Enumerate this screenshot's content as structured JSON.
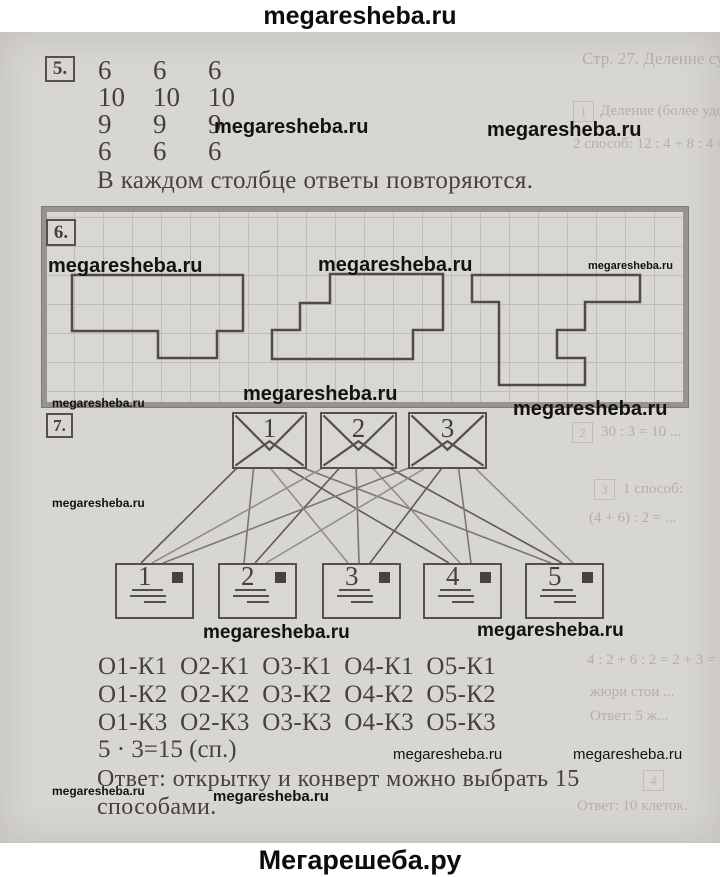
{
  "watermark_text": "megaresheba.ru",
  "header": {
    "site": "megaresheba.ru"
  },
  "footer": {
    "brand": "Мегарешеба.ру"
  },
  "problem5": {
    "label": "5.",
    "rows": [
      [
        "6",
        "6",
        "6"
      ],
      [
        "10",
        "10",
        "10"
      ],
      [
        "9",
        "9",
        "9"
      ],
      [
        "6",
        "6",
        "6"
      ]
    ],
    "note": "В каждом столбце ответы повторяются."
  },
  "problem6": {
    "label": "6.",
    "shapes": [
      {
        "name": "figure-left",
        "points": "72,275 243,275 243,331 217,331 217,358 158,358 158,331 72,331"
      },
      {
        "name": "figure-middle",
        "points": "330,274 443,274 443,330 413,330 413,359 272,359 272,330 300,330 300,303 330,303"
      },
      {
        "name": "figure-right",
        "points": "472,275 640,275 640,302 585,302 585,330 557,330 557,358 585,358 585,385 499,385 499,302 472,302"
      }
    ]
  },
  "problem7": {
    "label": "7.",
    "envelopes": [
      {
        "label": "1"
      },
      {
        "label": "2"
      },
      {
        "label": "3"
      }
    ],
    "postcards": [
      {
        "label": "1"
      },
      {
        "label": "2"
      },
      {
        "label": "3"
      },
      {
        "label": "4"
      },
      {
        "label": "5"
      }
    ],
    "envelope_anchors": [
      {
        "x": 267,
        "y": 464
      },
      {
        "x": 356,
        "y": 464
      },
      {
        "x": 445,
        "y": 464
      }
    ],
    "postcard_anchors": [
      {
        "x": 152,
        "y": 563
      },
      {
        "x": 255,
        "y": 563
      },
      {
        "x": 359,
        "y": 563
      },
      {
        "x": 460,
        "y": 563
      },
      {
        "x": 562,
        "y": 563
      }
    ],
    "line_colors": [
      "#5f5a55",
      "#7b7671",
      "#938e89"
    ],
    "combinations": [
      "О1-К1 О2-К1 О3-К1 О4-К1 О5-К1",
      "О1-К2 О2-К2 О3-К2 О4-К2 О5-К2",
      "О1-К3 О2-К3 О3-К3 О4-К3 О5-К3"
    ],
    "equation": "5 · 3=15 (сп.)",
    "answer_line1": "Ответ: открытку и конверт можно выбрать 15",
    "answer_line2": "способами."
  },
  "watermarks": [
    {
      "x": 214,
      "y": 117,
      "size": 20,
      "weight": 700
    },
    {
      "x": 487,
      "y": 120,
      "size": 20,
      "weight": 700
    },
    {
      "x": 48,
      "y": 256,
      "size": 20,
      "weight": 700
    },
    {
      "x": 318,
      "y": 255,
      "size": 20,
      "weight": 700
    },
    {
      "x": 588,
      "y": 261,
      "size": 11,
      "weight": 700
    },
    {
      "x": 243,
      "y": 384,
      "size": 20,
      "weight": 700
    },
    {
      "x": 52,
      "y": 397,
      "size": 12,
      "weight": 700
    },
    {
      "x": 513,
      "y": 399,
      "size": 20,
      "weight": 700
    },
    {
      "x": 52,
      "y": 497,
      "size": 12,
      "weight": 700
    },
    {
      "x": 203,
      "y": 623,
      "size": 19,
      "weight": 700
    },
    {
      "x": 477,
      "y": 621,
      "size": 19,
      "weight": 700
    },
    {
      "x": 393,
      "y": 747,
      "size": 15,
      "weight": 400
    },
    {
      "x": 573,
      "y": 747,
      "size": 15,
      "weight": 400
    },
    {
      "x": 52,
      "y": 785,
      "size": 12,
      "weight": 700
    },
    {
      "x": 213,
      "y": 789,
      "size": 15,
      "weight": 600
    }
  ],
  "ghosts": [
    {
      "text": "Стр. 27. Деление суммы на число",
      "x": 582,
      "y": 50,
      "size": 17
    },
    {
      "text": "1",
      "x": 573,
      "y": 101,
      "box": true
    },
    {
      "text": "Деление (более удобный)",
      "x": 600,
      "y": 103,
      "size": 15
    },
    {
      "text": "2 способ: 12 : 4 + 8 : 4 = 3 + 2 = 5 (б.)",
      "x": 573,
      "y": 136,
      "size": 15
    },
    {
      "text": "2 способ (более удобный)",
      "x": 478,
      "y": 220,
      "size": 15
    },
    {
      "text": "1 способ (по действиям):",
      "x": 470,
      "y": 316,
      "size": 15
    },
    {
      "text": "(14 + 16) : 3 = 10 (к.)",
      "x": 462,
      "y": 338,
      "size": 15
    },
    {
      "text": "способ: ... = 10 (к.)",
      "x": 448,
      "y": 360,
      "size": 15
    },
    {
      "text": "2",
      "x": 572,
      "y": 422,
      "box": true
    },
    {
      "text": "30 : 3 = 10 ...",
      "x": 601,
      "y": 424,
      "size": 15
    },
    {
      "text": "3",
      "x": 594,
      "y": 479,
      "box": true
    },
    {
      "text": "1 способ:",
      "x": 623,
      "y": 481,
      "size": 15
    },
    {
      "text": "(4 + 6) : 2 = ...",
      "x": 589,
      "y": 510,
      "size": 15
    },
    {
      "text": "4 : 2 + 6 : 2 = 2 + 3 = 5",
      "x": 587,
      "y": 652,
      "size": 15
    },
    {
      "text": "жюри стои ...",
      "x": 590,
      "y": 684,
      "size": 15
    },
    {
      "text": "Ответ: 5 ж...",
      "x": 590,
      "y": 708,
      "size": 15
    },
    {
      "text": "4",
      "x": 643,
      "y": 770,
      "box": true
    },
    {
      "text": "Ответ: 10 клеток.",
      "x": 577,
      "y": 798,
      "size": 15
    }
  ],
  "colors": {
    "paper": "#d8d6d2",
    "ink": "#46413c",
    "watermark": "#141211",
    "grid": "#c0bdb8",
    "figure_stroke": "#504b46",
    "box6_border": "#97938e"
  }
}
